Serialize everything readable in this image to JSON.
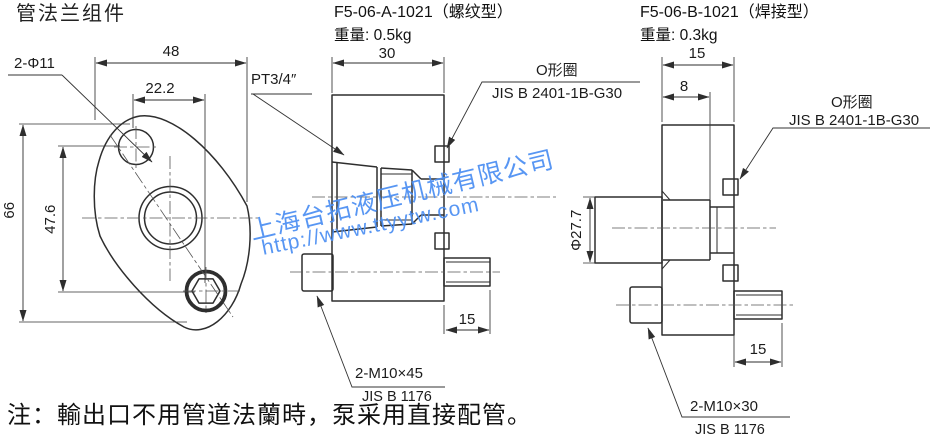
{
  "title": "管法兰组件",
  "note": "注：輸出口不用管道法蘭時，泵采用直接配管。",
  "watermark": {
    "company": "上海台拓液压机械有限公司",
    "url": "http://www.ttyytw.com",
    "color": "#4a8ef2"
  },
  "flange_view": {
    "dim_width": "48",
    "dim_bolt_spacing_x": "22.2",
    "dim_bolt_holes": "2-Φ11",
    "dim_height": "66",
    "dim_bolt_spacing_y": "47.6"
  },
  "threaded_view": {
    "part_no": "F5-06-A-1021（螺纹型）",
    "weight": "重量: 0.5kg",
    "dim_depth": "30",
    "thread_label": "PT3/4″",
    "oring_label": "O形圈",
    "oring_spec": "JIS B 2401-1B-G30",
    "dim_bolt_protrusion": "15",
    "bolt_label": "2-M10×45",
    "bolt_spec": "JIS B 1176"
  },
  "welded_view": {
    "part_no": "F5-06-B-1021（焊接型）",
    "weight": "重量: 0.3kg",
    "dim_depth": "15",
    "dim_bore_depth": "8",
    "oring_label": "O形圈",
    "oring_spec": "JIS B 2401-1B-G30",
    "dim_pipe_od": "Φ27.7",
    "dim_bolt_protrusion": "15",
    "bolt_label": "2-M10×30",
    "bolt_spec": "JIS B 1176"
  }
}
